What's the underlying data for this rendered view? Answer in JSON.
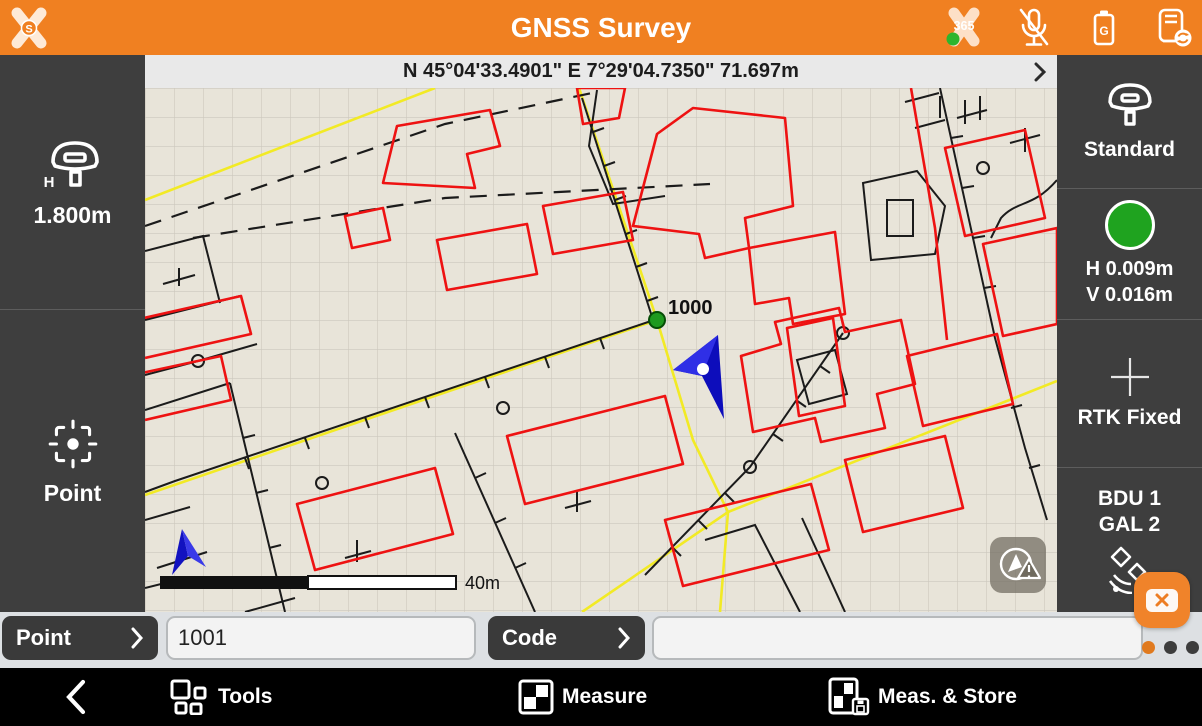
{
  "header": {
    "title": "GNSS Survey",
    "logo_letter": "S",
    "x365_label": "365",
    "battery_letter": "G"
  },
  "coordbar": {
    "text": "N 45°04'33.4901\" E 7°29'04.7350\" 71.697m"
  },
  "sidebar_left": {
    "antenna_height": "1.800m",
    "point_label": "Point"
  },
  "sidebar_right": {
    "profile": "Standard",
    "h_acc": "H 0.009m",
    "v_acc": "V 0.016m",
    "fix_status": "RTK Fixed",
    "sat_line1": "BDU 1",
    "sat_line2": "GAL 2"
  },
  "map": {
    "point_label": "1000",
    "scale_label": "40m"
  },
  "input_row": {
    "point_button": "Point",
    "point_value": "1001",
    "code_button": "Code",
    "code_value": ""
  },
  "bottom_bar": {
    "tools": "Tools",
    "measure": "Measure",
    "meas_store": "Meas. & Store"
  },
  "colors": {
    "orange": "#f08021",
    "sidebar_dark": "#3e3e3e",
    "map_bg": "#e8e4d9",
    "road_yellow": "#f2ea25",
    "building_red": "#ee1212",
    "fix_green": "#1fa31f",
    "arrow_blue": "#1111bb"
  }
}
